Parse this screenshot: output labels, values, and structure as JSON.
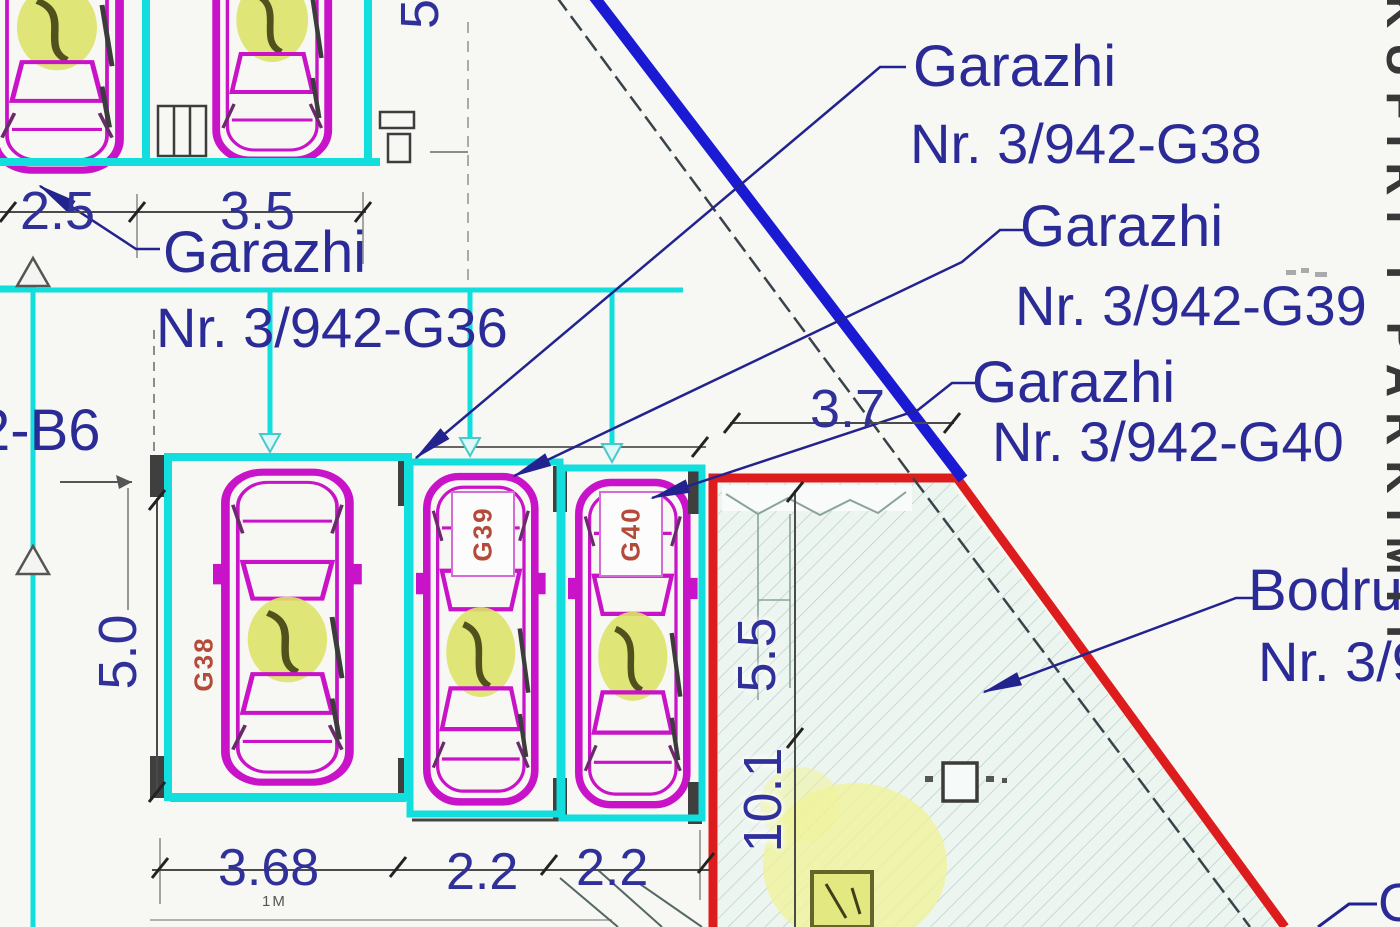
{
  "labels": {
    "g36": {
      "line1": "Garazhi",
      "line2": "Nr. 3/942-G36"
    },
    "g38": {
      "line1": "Garazhi",
      "line2": "Nr. 3/942-G38"
    },
    "g39": {
      "line1": "Garazhi",
      "line2": "Nr. 3/942-G39"
    },
    "g40": {
      "line1": "Garazhi",
      "line2": "Nr. 3/942-G40"
    },
    "bodrumi": {
      "line1": "Bodru",
      "line2": "Nr. 3/9"
    },
    "parcel_left_fragment": "2-B6",
    "corner_fragment": "G",
    "edge_vertical_text": "KUFIRI I PARKIMIT"
  },
  "car_tags": {
    "g38": "G38",
    "g39": "G39",
    "g40": "G40"
  },
  "dimensions": {
    "top": [
      "2.5",
      "3.5"
    ],
    "bottom": [
      "3.68",
      "2.2",
      "2.2"
    ],
    "left_height": "5.0",
    "top_right_partial": "5",
    "red_top_width": "3.7",
    "red_side_upper": "5.5",
    "red_side_lower": "10.1",
    "small_note": "1M"
  },
  "colors": {
    "cyan_outline": "#12dede",
    "magenta_car": "#c813c8",
    "navy_text": "#2b2b98",
    "blue_boundary_line": "#1a1ad2",
    "red_boundary": "#dd1d1d",
    "hatch_fill": "#edf5f0",
    "hatch_line": "#b7cfc6",
    "highlight_yellow": "#eff29b",
    "car_tag_red": "#b34a3a"
  }
}
